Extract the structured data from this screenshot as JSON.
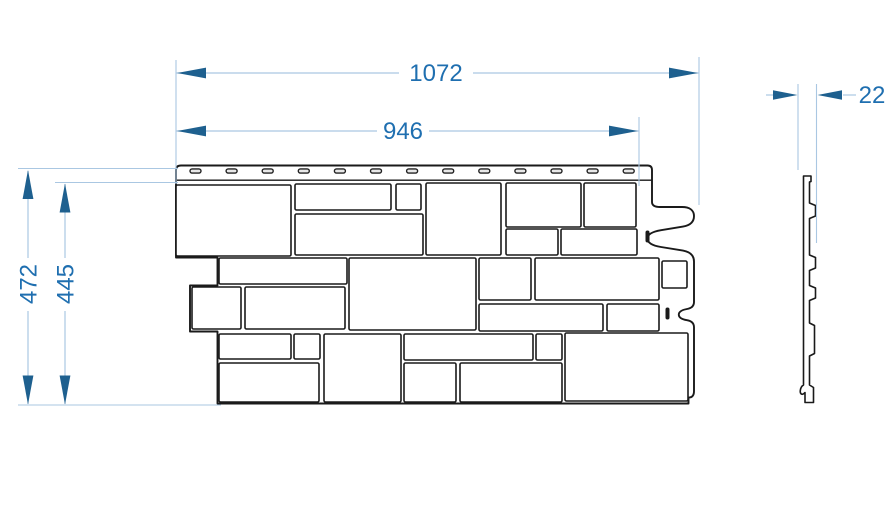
{
  "drawing": {
    "title": "facade-panel-dimension-drawing",
    "dimensions": {
      "front_total_width": "1072",
      "front_exposed_width": "946",
      "total_height": "472",
      "exposed_height": "445",
      "thickness": "22"
    },
    "colors": {
      "dimension_line": "#aac7e2",
      "dimension_arrow": "#1e608f",
      "dimension_text": "#1f6fb0",
      "outline": "#1a1a1a",
      "background": "#ffffff"
    },
    "panel": {
      "nail_slots": {
        "count": 13,
        "start_cx": 195.5,
        "spacing": 36.1,
        "width": 11,
        "height": 4.2,
        "y": 168.9
      },
      "edge_slots": [
        [
          645.5,
          230.5,
          4,
          12
        ],
        [
          665.5,
          307.5,
          4,
          12
        ]
      ],
      "blocks": [
        [
          176,
          185,
          115,
          71
        ],
        [
          295,
          184,
          96,
          26
        ],
        [
          396,
          184,
          25,
          26
        ],
        [
          295,
          214,
          128,
          41
        ],
        [
          426,
          183,
          75,
          72
        ],
        [
          506,
          183,
          75,
          44
        ],
        [
          584,
          183,
          52,
          44
        ],
        [
          506,
          229,
          52,
          26
        ],
        [
          561,
          229,
          76,
          26
        ],
        [
          219,
          258,
          128,
          26
        ],
        [
          349,
          258,
          127,
          72
        ],
        [
          192,
          287,
          49,
          42
        ],
        [
          245,
          287,
          100,
          42
        ],
        [
          479,
          258,
          52,
          42
        ],
        [
          535,
          258,
          124,
          42
        ],
        [
          662,
          261,
          25,
          27
        ],
        [
          479,
          304,
          124,
          27
        ],
        [
          607,
          304,
          52,
          27
        ],
        [
          219,
          334,
          72,
          25
        ],
        [
          294,
          334,
          26,
          25
        ],
        [
          324,
          334,
          77,
          68
        ],
        [
          404,
          334,
          129,
          26
        ],
        [
          536,
          334,
          26,
          26
        ],
        [
          565,
          333,
          123,
          68
        ],
        [
          219,
          363,
          100,
          39
        ],
        [
          404,
          363,
          52,
          39
        ],
        [
          460,
          363,
          102,
          39
        ]
      ]
    }
  }
}
